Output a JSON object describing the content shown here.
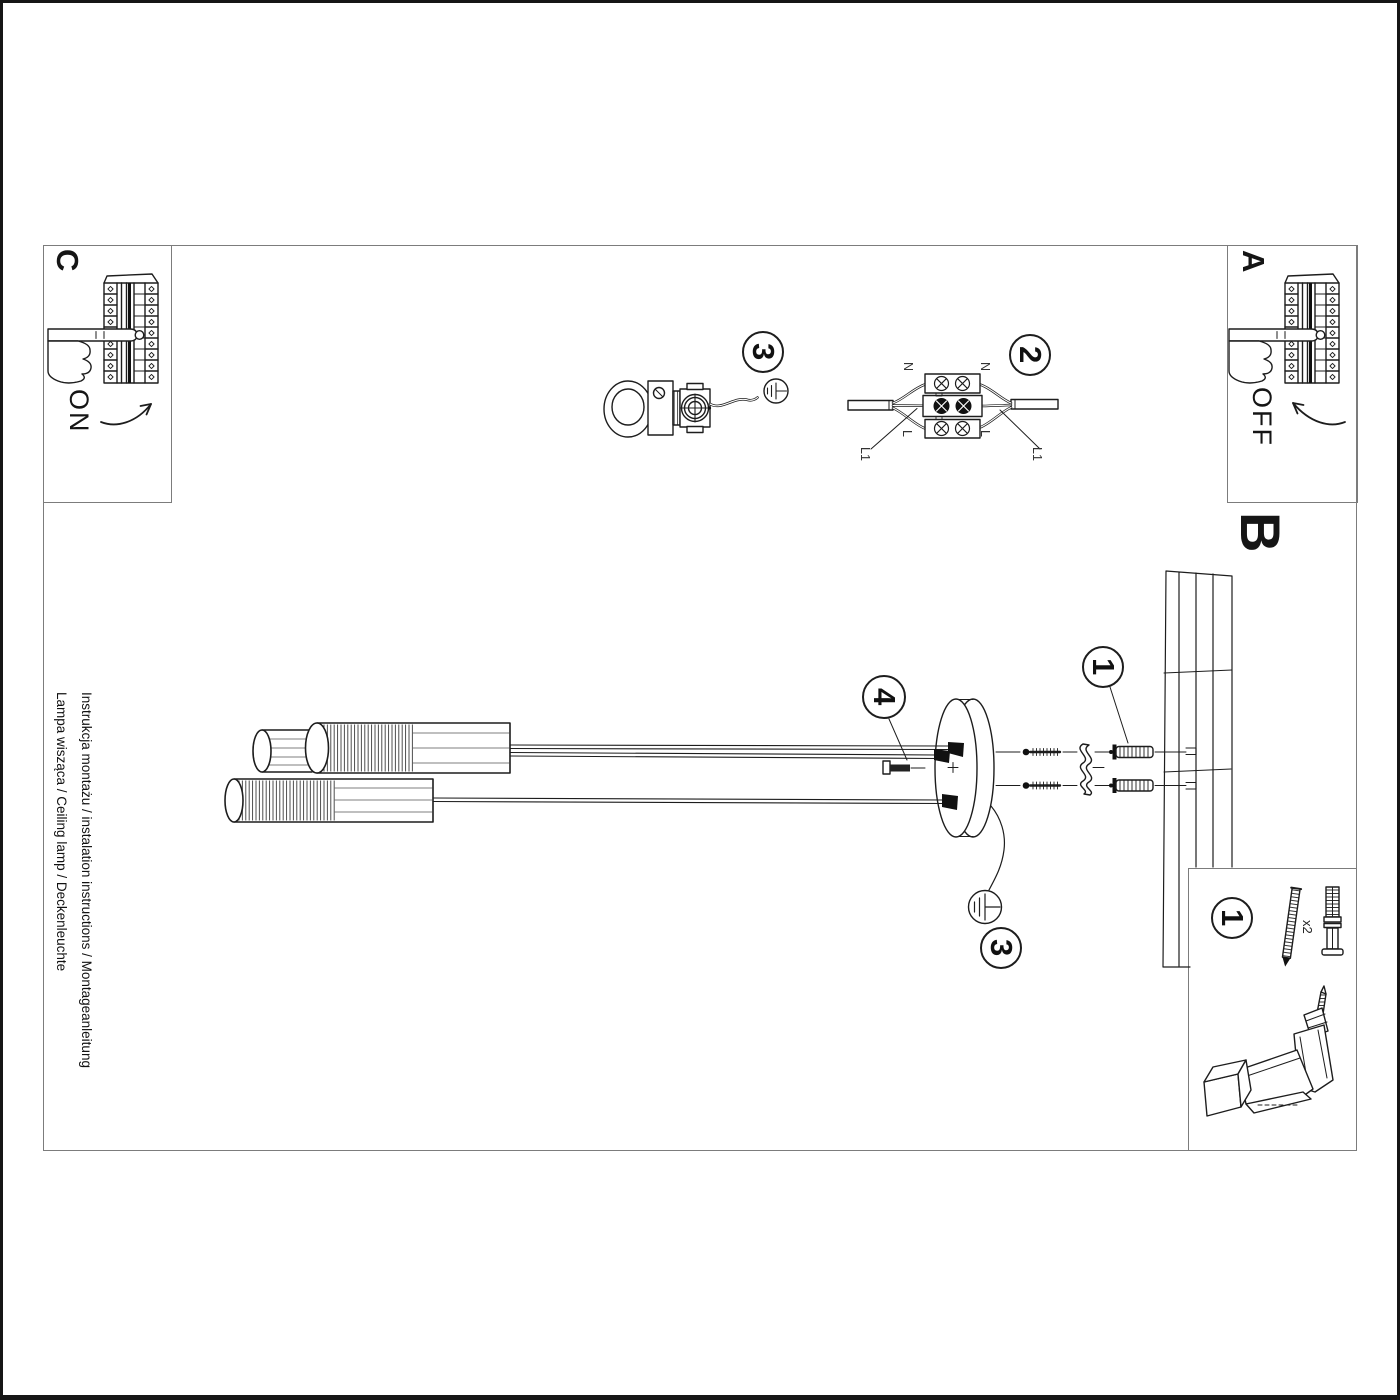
{
  "sheet": {
    "sections": {
      "a": "A",
      "b": "B",
      "c": "C"
    },
    "switch": {
      "on": "ON",
      "off": "OFF"
    },
    "steps": {
      "mount": "1",
      "wiring": "2",
      "hook": "3",
      "ground": "3",
      "bolt": "4"
    },
    "terminal": {
      "n_left": "N",
      "n_right": "N",
      "l_left": "L",
      "l_right": "L",
      "l1_left": "L1",
      "l1_right": "L1"
    },
    "parts": {
      "badge": "1",
      "screws_qty": "x2"
    },
    "footer": {
      "line1": "Instrukcja montażu / instalation instructions / Montageanleitung",
      "line2": "Lampa wisząca / Ceiling lamp / Deckenleuchte"
    },
    "colors": {
      "ink": "#1d1d1d",
      "frame": "#7c7c7c",
      "paper": "#ffffff"
    }
  }
}
